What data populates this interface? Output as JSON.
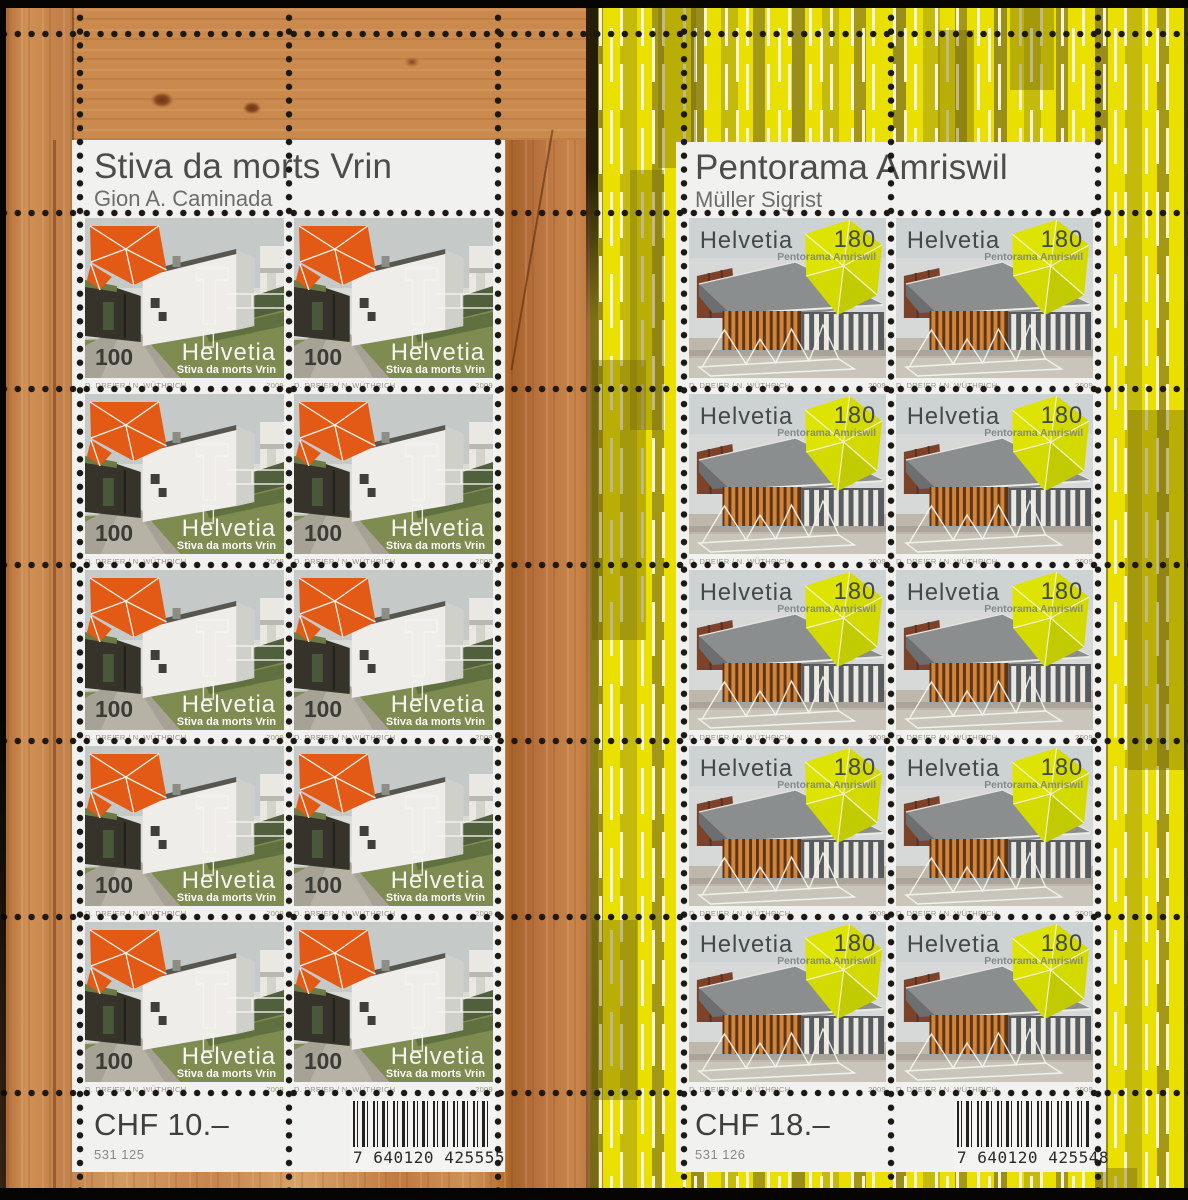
{
  "left_sheet": {
    "title": "Stiva da morts Vrin",
    "architect": "Gion A. Caminada",
    "stamp": {
      "value": "100",
      "country": "Helvetia",
      "caption": "Stiva da morts Vrin",
      "designers": "D. DREIER / N. WÜTHRICH",
      "year": "2009"
    },
    "price": "CHF 10.–",
    "order_number": "531 125",
    "barcode_digits": "7 640120 425555"
  },
  "right_sheet": {
    "title": "Pentorama Amriswil",
    "architect": "Müller Sigrist",
    "stamp": {
      "value": "180",
      "country": "Helvetia",
      "caption": "Pentorama Amriswil",
      "designers": "D. DREIER / N. WÜTHRICH",
      "year": "2009"
    },
    "price": "CHF 18.–",
    "order_number": "531 126",
    "barcode_digits": "7 640120 425548"
  },
  "colors": {
    "stamp_orange": "#e25a15",
    "stamp_yellow_green": "#d3da00",
    "sheet_white": "#f1f1ef",
    "wood_brown": "#c07a40",
    "margin_yellow": "#e9e000"
  }
}
